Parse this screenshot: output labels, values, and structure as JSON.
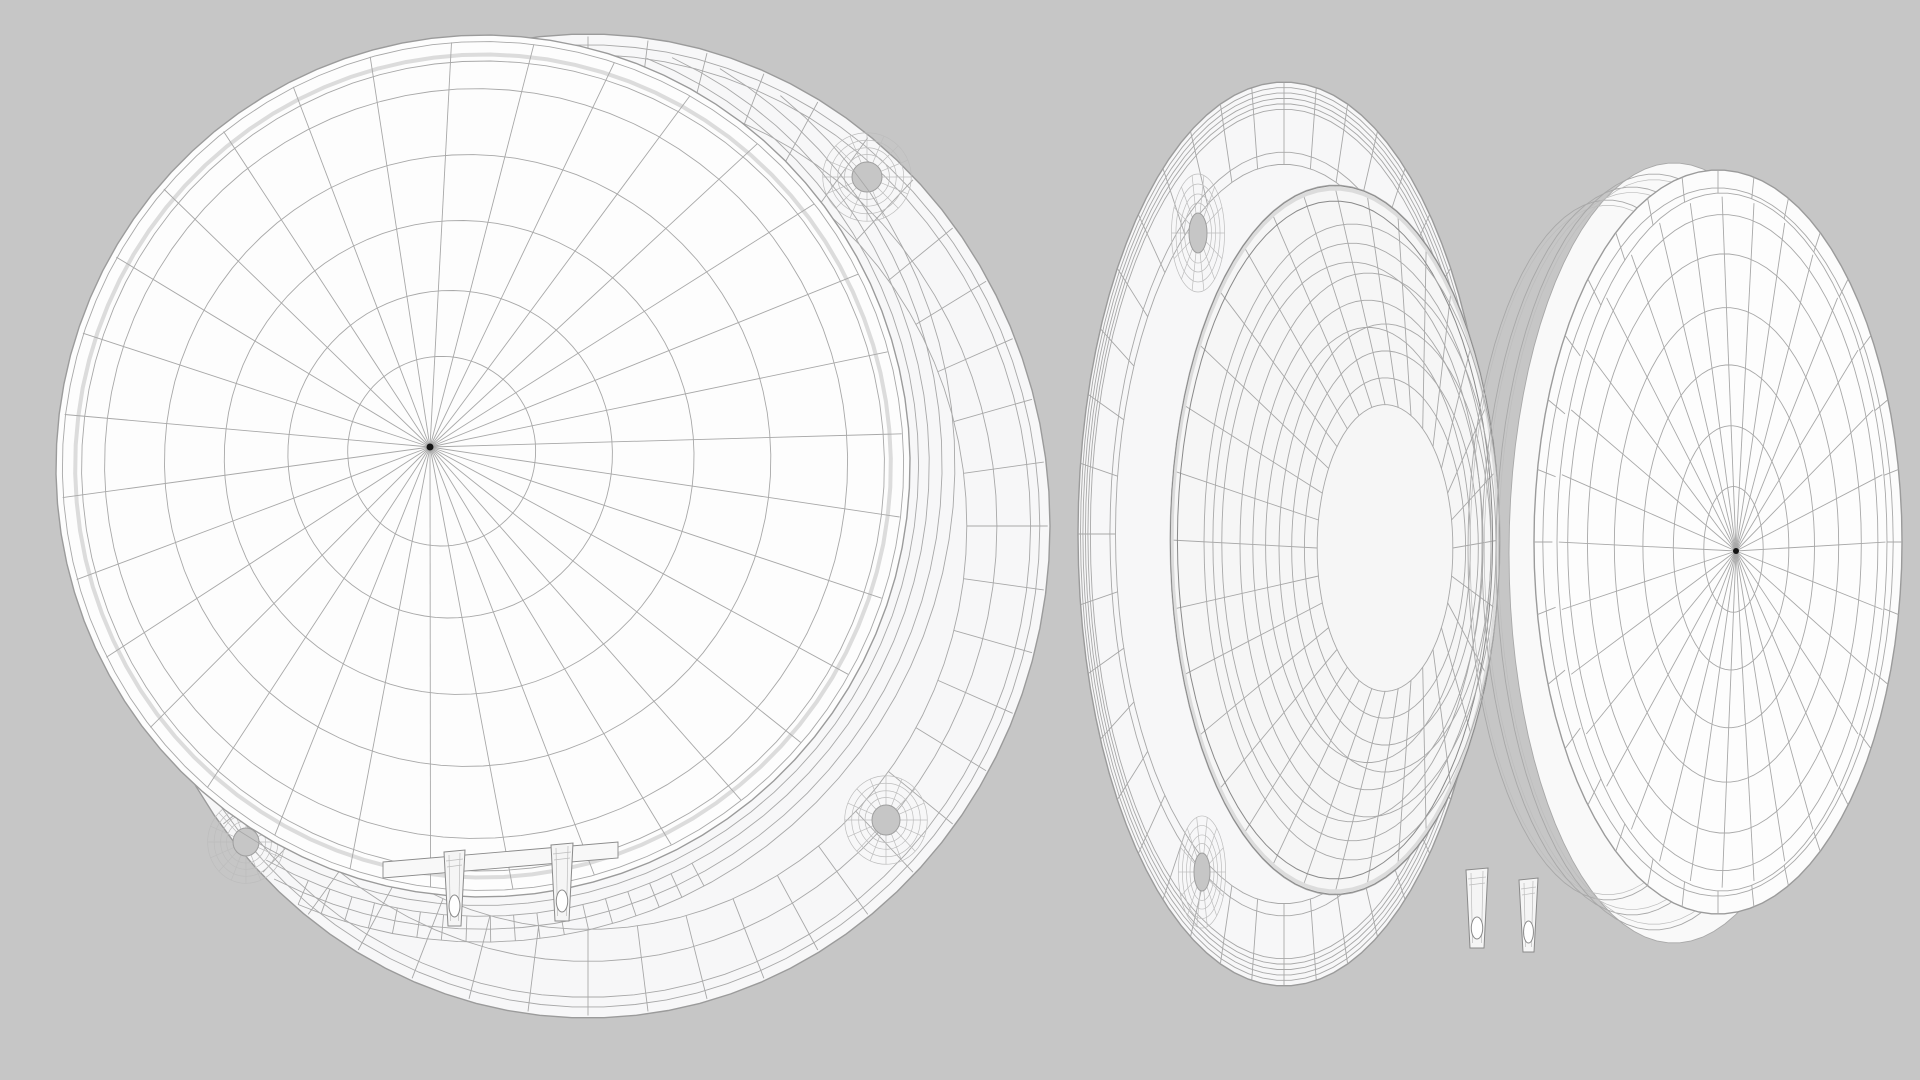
{
  "scene": {
    "description": "Monochrome 3D wireframe render of a loudspeaker driver shown in two views: front three-quarter view (left) and rear-side view (right)",
    "width": 1920,
    "height": 1080,
    "viewbox": "0 0 1920 1080",
    "background": "#c6c6c6",
    "palette": {
      "flange_fill": "#f7f7f8",
      "cone_fill": "#fdfdfd",
      "bowl_fill": "#f6f6f6",
      "band_fill": "#f9f9f9",
      "dome_fill": "#fcfcfc",
      "tab_fill": "#f5f5f5",
      "plate_fill": "#f8f8f8",
      "hole_fill": "#c6c6c6",
      "dot": "#141414"
    },
    "styles": {
      "base": {
        "s": "#a8a8a8",
        "w": 0.9
      },
      "soft": {
        "s": "#bdbdbd",
        "w": 0.7
      },
      "dark": {
        "s": "#8a8a8a",
        "w": 1.0
      },
      "edge": {
        "s": "#9b9b9b",
        "w": 1.4
      },
      "highlight": {
        "s": "#dcdcdc",
        "w": 4.0
      }
    }
  },
  "front_view": {
    "name": "speaker driver, front three-quarter view",
    "flange": {
      "cx": 588,
      "cy": 526,
      "rx": 462,
      "ry": 492,
      "rot": 0
    },
    "flange_rings": [
      0.978,
      0.958,
      0.885,
      0.82
    ],
    "flange_spokes": {
      "count": 48,
      "from": 0.82,
      "to": 0.995
    },
    "screw_holes": [
      {
        "cx": 867,
        "cy": 177,
        "rx": 15,
        "ry": 15
      },
      {
        "cx": 886,
        "cy": 820,
        "rx": 14,
        "ry": 15
      },
      {
        "cx": 246,
        "cy": 842,
        "rx": 13,
        "ry": 14
      }
    ],
    "web": {
      "ring_scales": [
        1.5,
        1.95,
        2.45,
        2.95
      ],
      "spoke_count": 16
    },
    "surround": {
      "cx": 483,
      "cy": 466,
      "rx": 427,
      "ry": 431,
      "rot": 7,
      "arcs": [
        {
          "f": 1.02,
          "a0": -75,
          "a1": 118
        },
        {
          "f": 1.045,
          "a0": -72,
          "a1": 114
        },
        {
          "f": 1.075,
          "a0": -66,
          "a1": 110
        },
        {
          "f": 1.105,
          "a0": -58,
          "a1": 106
        }
      ],
      "spokes": {
        "from": 1.045,
        "to": 1.105,
        "count": 18,
        "a0": 55,
        "a1": 106
      }
    },
    "cone": {
      "cx": 483,
      "cy": 466,
      "rx": 427,
      "ry": 431,
      "rot": 7,
      "apex": {
        "x": 430,
        "y": 447
      },
      "rays": 32,
      "ray_to": 0.985,
      "rings": [
        0.22,
        0.38,
        0.55,
        0.71,
        0.87
      ],
      "edge_rings": [
        0.94,
        0.985
      ],
      "highlight_ring": 0.955,
      "dot_r": 3.5
    },
    "terminal_plate": {
      "pts": [
        [
          383,
          862
        ],
        [
          618,
          842
        ],
        [
          618,
          858
        ],
        [
          383,
          878
        ]
      ]
    },
    "terminals": [
      {
        "x": 444,
        "y": 852,
        "w": 21,
        "h": 74
      },
      {
        "x": 551,
        "y": 845,
        "w": 22,
        "h": 76
      }
    ]
  },
  "side_view": {
    "name": "speaker driver, rear-side view",
    "flange": {
      "cx": 1284,
      "cy": 534,
      "rx": 206,
      "ry": 452,
      "rot": 0
    },
    "flange_rings": [
      0.988,
      0.976,
      0.964,
      0.952,
      0.94,
      0.845,
      0.818
    ],
    "flange_spokes": {
      "count": 40,
      "from": 0.818,
      "to": 0.998
    },
    "screw_holes": [
      {
        "cx": 1198,
        "cy": 233,
        "rx": 9,
        "ry": 20
      },
      {
        "cx": 1202,
        "cy": 872,
        "rx": 8,
        "ry": 19
      }
    ],
    "web": {
      "ring_scales": [
        1.5,
        1.95,
        2.45,
        2.95
      ],
      "spoke_count": 14
    },
    "bowl": {
      "outer": {
        "cx": 1335,
        "cy": 540,
        "rx": 165,
        "ry": 355
      },
      "outer_rings": [
        0.998,
        0.955
      ],
      "highlight_ring": 0.99,
      "steps": [
        {
          "cx": 1352,
          "cy": 542,
          "rx": 148,
          "ry": 318,
          "rings": [
            1.0,
            0.94,
            0.88
          ]
        },
        {
          "cx": 1368,
          "cy": 545,
          "rx": 128,
          "ry": 272,
          "rings": [
            1.0,
            0.9,
            0.8
          ]
        },
        {
          "cx": 1385,
          "cy": 548,
          "rx": 106,
          "ry": 224,
          "rings": [
            1.0,
            0.88,
            0.76,
            0.64
          ]
        }
      ],
      "inner": {
        "cx": 1385,
        "cy": 548,
        "rx": 106,
        "ry": 224,
        "f": 0.64
      },
      "spoke_count": 32
    },
    "gasket": {
      "fill_band": {
        "cx": 1674,
        "cy": 553,
        "rx": 165,
        "ry": 390
      },
      "bands": [
        {
          "cx": 1608,
          "cy": 550,
          "rx": 140,
          "ry": 350
        },
        {
          "cx": 1632,
          "cy": 551,
          "rx": 150,
          "ry": 364
        },
        {
          "cx": 1654,
          "cy": 552,
          "rx": 158,
          "ry": 378
        }
      ],
      "inner_ring": 0.985
    },
    "dome": {
      "outer": {
        "cx": 1718,
        "cy": 542,
        "rx": 184,
        "ry": 372
      },
      "surround_spokes": {
        "count": 32,
        "from": 0.9,
        "to": 1.0
      },
      "surround_ring": 0.952,
      "disc": {
        "cx": 1722,
        "cy": 542,
        "rx": 165,
        "ry": 349
      },
      "apex": {
        "x": 1736,
        "y": 551
      },
      "rays": 32,
      "ray_to": 0.99,
      "rings": [
        0.18,
        0.35,
        0.52,
        0.68,
        0.83,
        0.94
      ],
      "dot_r": 3
    },
    "terminals": [
      {
        "x": 1466,
        "y": 870,
        "w": 22,
        "h": 78
      },
      {
        "x": 1519,
        "y": 880,
        "w": 19,
        "h": 72
      }
    ]
  }
}
